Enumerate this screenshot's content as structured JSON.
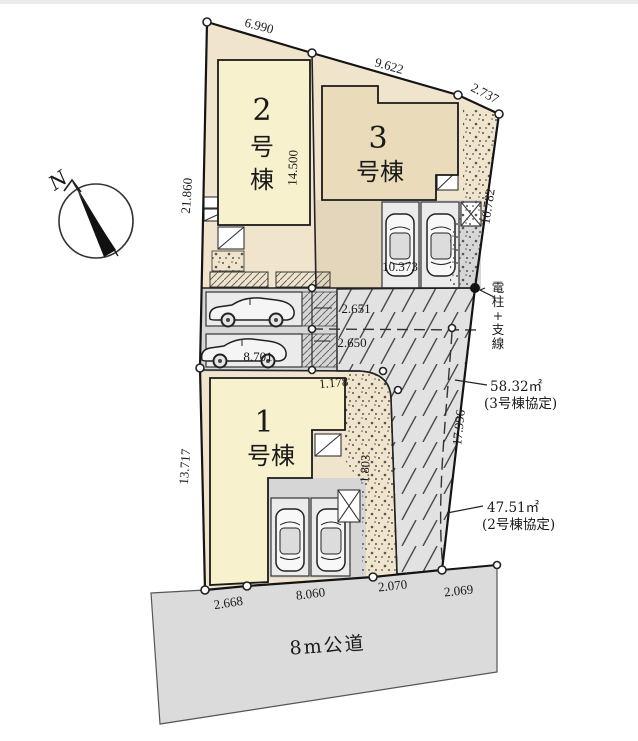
{
  "site_plan": {
    "compass": {
      "north_label": "N"
    },
    "road": {
      "label": "8m公道"
    },
    "buildings": [
      {
        "name": "1号棟",
        "number": "1",
        "suffix": "号棟"
      },
      {
        "name": "2号棟",
        "number": "2",
        "suffix_char_1": "号",
        "suffix_char_2": "棟"
      },
      {
        "name": "3号棟",
        "number": "3",
        "suffix": "号棟"
      }
    ],
    "boundary_dimensions": {
      "top_edge_left": "6.990",
      "top_edge_right": "9.622",
      "top_corner": "2.737",
      "left_upper": "21.860",
      "left_lower": "13.717",
      "right_upper": "10.782",
      "right_lower": "17.996",
      "bottom_1": "2.668",
      "bottom_2": "8.060",
      "bottom_3": "2.070",
      "bottom_4": "2.069"
    },
    "internal_dimensions": {
      "building2_depth": "14.500",
      "parking3_width": "10.373",
      "mid_parking_upper": "2.651",
      "mid_parking_lower": "2.650",
      "mid_parking_width": "8.701",
      "plot1_corner": "1.178",
      "plot1_side": "1.803"
    },
    "annotations": {
      "utility_pole_chars": [
        "電",
        "柱",
        "+",
        "支",
        "線"
      ],
      "area_building3": {
        "value": "58.32㎡",
        "note": "(3号棟協定)"
      },
      "area_building2": {
        "value": "47.51㎡",
        "note": "(2号棟協定)"
      }
    }
  }
}
